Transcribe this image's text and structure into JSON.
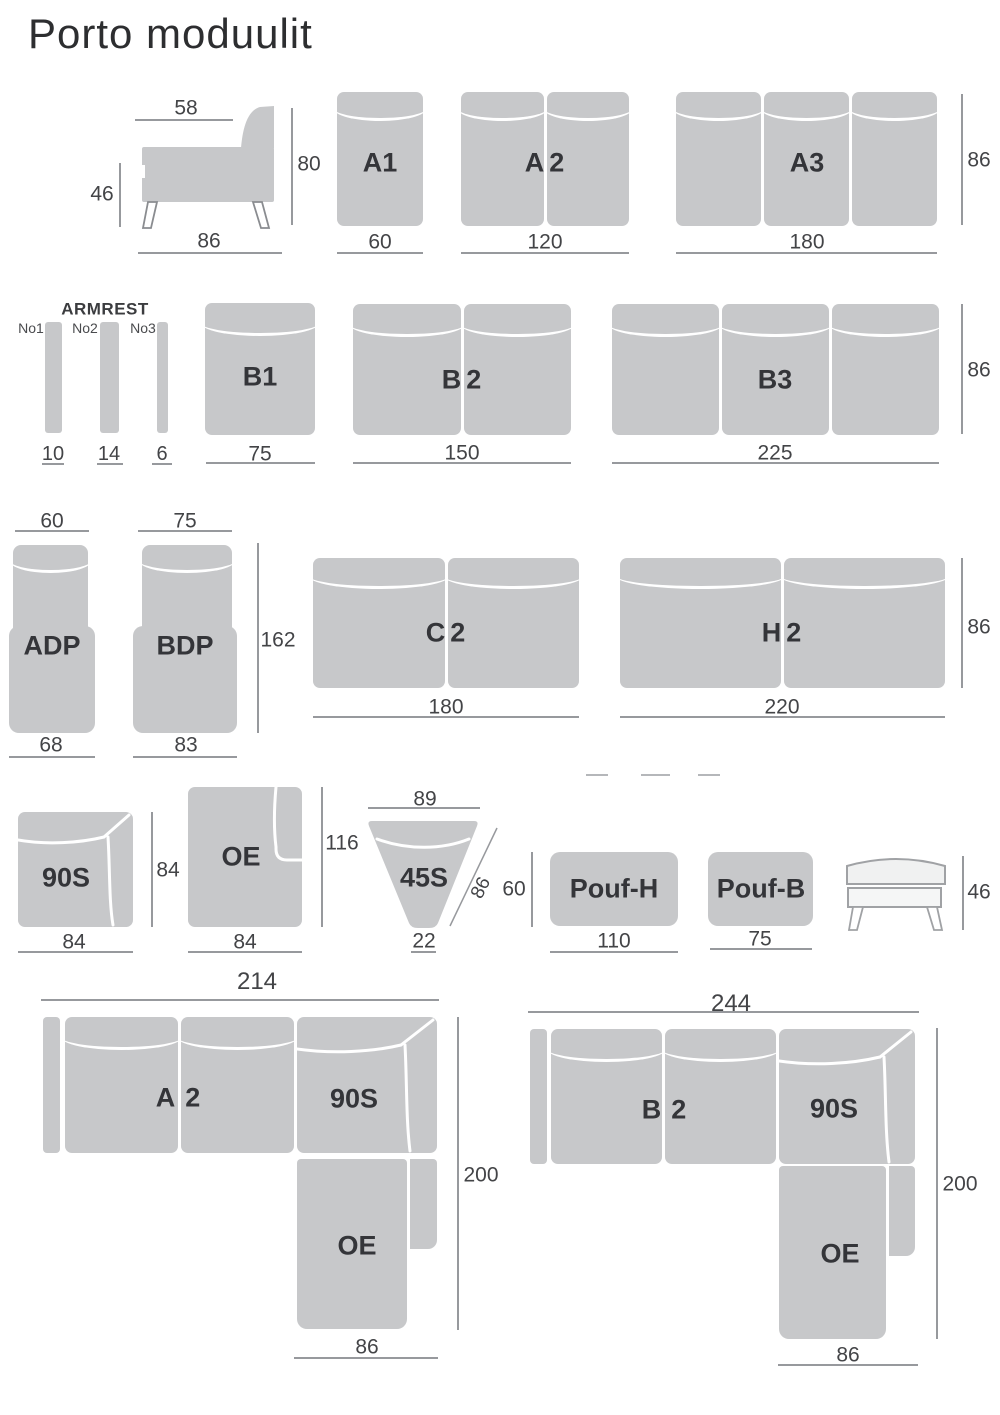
{
  "title": "Porto moduulit",
  "side_sofa": {
    "width_top": "58",
    "height": "80",
    "seat_height": "46",
    "depth": "86"
  },
  "row1": {
    "a1": {
      "label": "A1",
      "width": "60"
    },
    "a2": {
      "label": "A2",
      "width": "120"
    },
    "a3": {
      "label": "A3",
      "width": "180"
    },
    "height": "86"
  },
  "row2": {
    "armrest_title": "ARMREST",
    "no1": {
      "name": "No1",
      "width": "10"
    },
    "no2": {
      "name": "No2",
      "width": "14"
    },
    "no3": {
      "name": "No3",
      "width": "6"
    },
    "b1": {
      "label": "B1",
      "width": "75"
    },
    "b2": {
      "label": "B2",
      "width": "150"
    },
    "b3": {
      "label": "B3",
      "width": "225"
    },
    "height": "86"
  },
  "row3": {
    "adp": {
      "label": "ADP",
      "width_top": "60",
      "width_bottom": "68"
    },
    "bdp": {
      "label": "BDP",
      "width_top": "75",
      "width_bottom": "83"
    },
    "depth": "162",
    "c2": {
      "label": "C2",
      "width": "180"
    },
    "h2": {
      "label": "H2",
      "width": "220"
    },
    "height": "86"
  },
  "row4": {
    "s90": {
      "label": "90S",
      "width": "84",
      "height": "84"
    },
    "oe": {
      "label": "OE",
      "width": "84",
      "height": "116"
    },
    "s45": {
      "label": "45S",
      "width_top": "89",
      "width_bottom": "22",
      "side": "86"
    },
    "pouf_h": {
      "label": "Pouf-H",
      "width": "110",
      "height": "60"
    },
    "pouf_b": {
      "label": "Pouf-B",
      "width": "75"
    },
    "bench": {
      "height": "46"
    }
  },
  "config1": {
    "total_width": "214",
    "seat_label": "A2",
    "corner_label": "90S",
    "oe_label": "OE",
    "depth": "200",
    "oe_width": "86"
  },
  "config2": {
    "total_width": "244",
    "seat_label": "B2",
    "corner_label": "90S",
    "oe_label": "OE",
    "depth": "200",
    "oe_width": "86"
  },
  "colors": {
    "module_fill": "#c7c8ca",
    "seam": "#ffffff",
    "dim_line": "#97999d",
    "dim_text": "#434447",
    "label_text": "#343539"
  }
}
